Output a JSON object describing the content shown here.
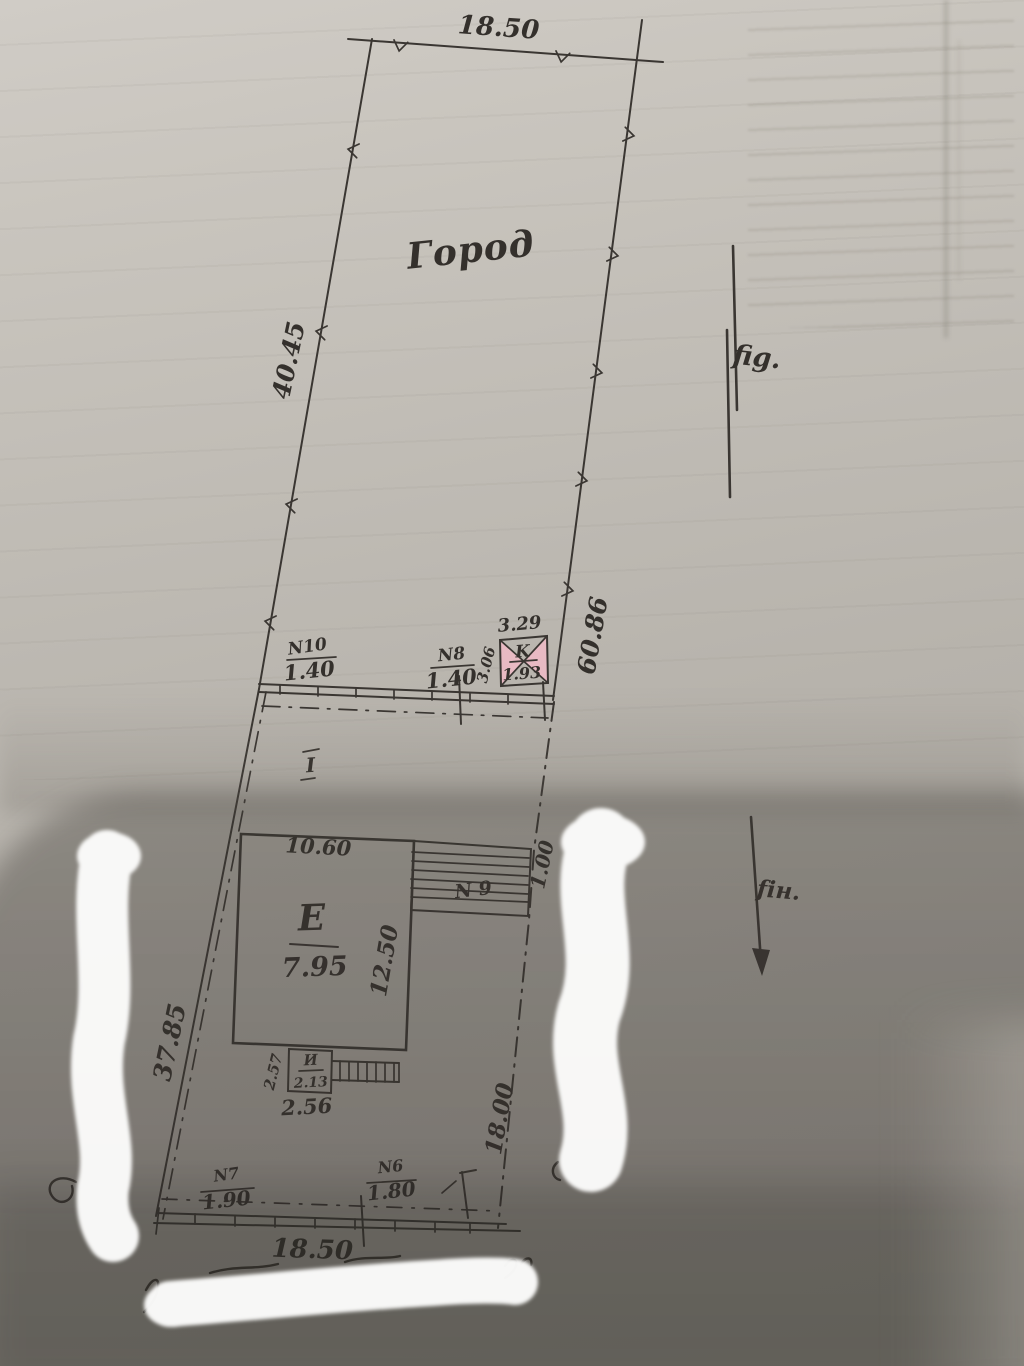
{
  "plan": {
    "garden_label": "Город",
    "fig_label": "fig.",
    "fin_label": "fін.",
    "dims": {
      "top": "18.50",
      "upper_left": "40.45",
      "upper_right": "60.86",
      "lower_left": "37.85",
      "lower_right": "18.00",
      "bottom": "18.50",
      "partial_right": "1.00"
    },
    "marks": {
      "inner": "I"
    },
    "k": {
      "label": "K",
      "value": "1.93",
      "top": "3.29",
      "side": "3.06"
    },
    "e": {
      "label": "E",
      "value": "7.95",
      "top": "10.60",
      "side": "12.50"
    },
    "i": {
      "label": "И",
      "value": "2.13",
      "side": "2.57",
      "bottom": "2.56"
    },
    "fences": {
      "n10": {
        "name": "N10",
        "value": "1.40"
      },
      "n8": {
        "name": "N8",
        "value": "1.40"
      },
      "n9": {
        "name": "N 9"
      },
      "n7": {
        "name": "N7",
        "value": "1.90"
      },
      "n6": {
        "name": "N6",
        "value": "1.80"
      }
    },
    "colors": {
      "ink": "#3a3632",
      "building_fill": "#d5b6bc",
      "k_fill": "#e8bac3",
      "paper": "#c0bcb5",
      "whiteout": "#fcfcfb"
    }
  }
}
